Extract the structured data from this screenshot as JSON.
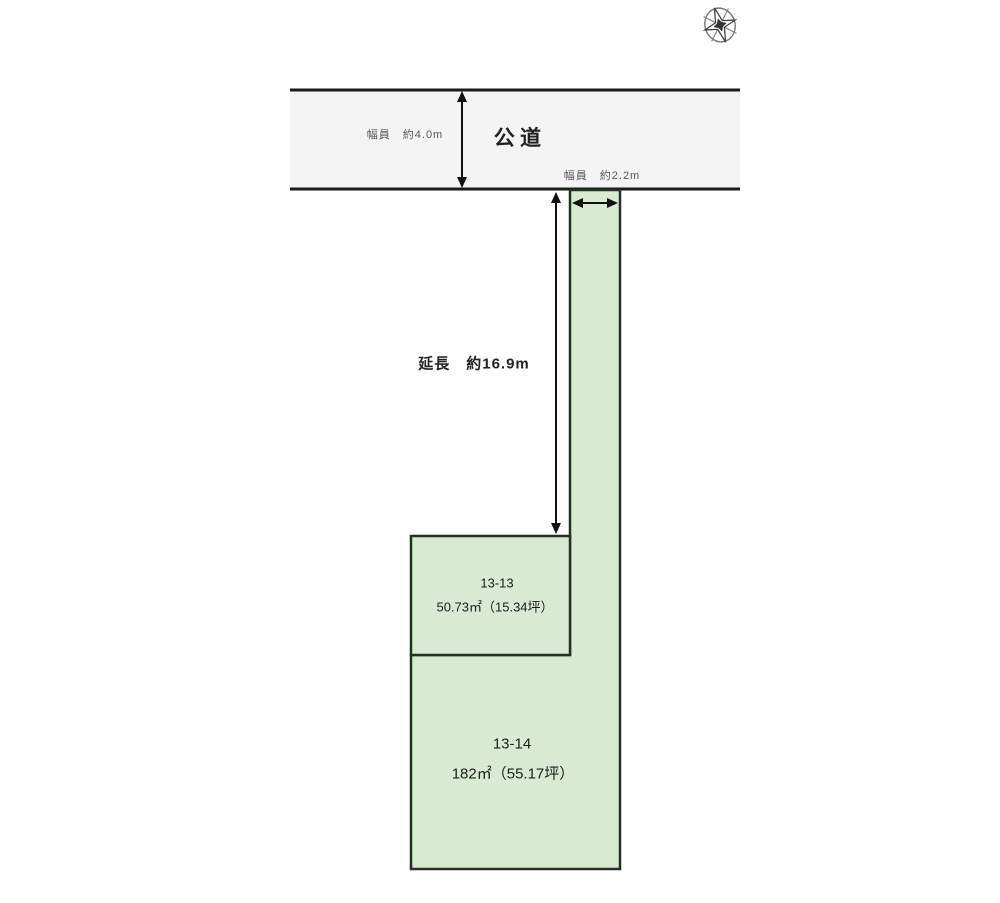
{
  "diagram": {
    "title": "land-plot-plan",
    "compass": {
      "icon": "compass-rose-icon"
    },
    "road": {
      "name_label": "公道",
      "width_label": "幅員　約4.0m"
    },
    "approach": {
      "width_label": "幅員　約2.2m",
      "length_label": "延長　約16.9m"
    },
    "parcels": [
      {
        "id": "13-13",
        "area": "50.73㎡（15.34坪）"
      },
      {
        "id": "13-14",
        "area": "182㎡（55.17坪）"
      }
    ],
    "colors": {
      "parcel_fill": "#d9ead3",
      "parcel_border": "#233023",
      "road_fill": "#f4f4f4",
      "line_color": "#111111"
    }
  }
}
